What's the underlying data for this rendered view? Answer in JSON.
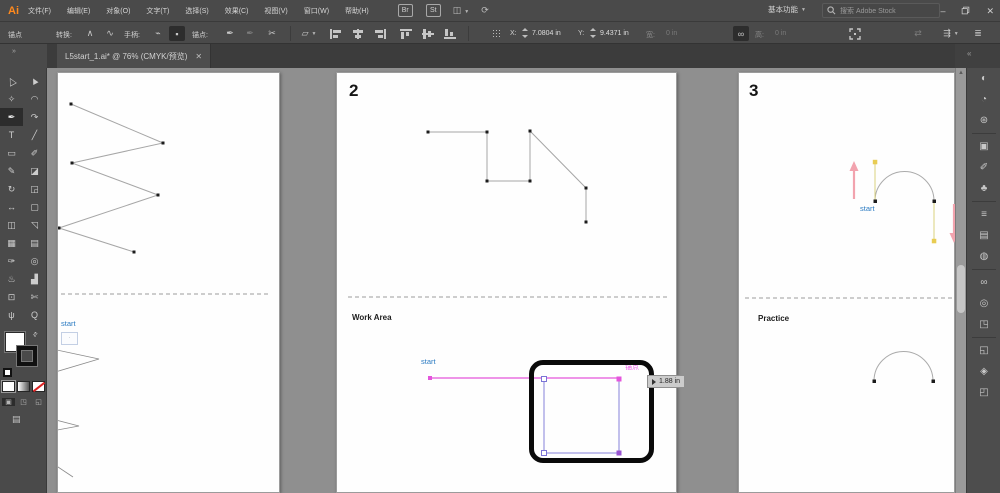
{
  "colors": {
    "chrome_bg": "#4a4a4a",
    "pasteboard": "#8f8f8f",
    "accent_blue": "#2b7bc2",
    "smart_guide_magenta": "#e455dc",
    "path_violet": "#8781d9",
    "handle_yellow": "#e8cc52",
    "arrow_pink": "#f2a3ae"
  },
  "menu_bar": {
    "logo": "Ai",
    "items": [
      {
        "label": "文件(F)"
      },
      {
        "label": "编辑(E)"
      },
      {
        "label": "对象(O)"
      },
      {
        "label": "文字(T)"
      },
      {
        "label": "选择(S)"
      },
      {
        "label": "效果(C)"
      },
      {
        "label": "视图(V)"
      },
      {
        "label": "窗口(W)"
      },
      {
        "label": "帮助(H)"
      }
    ],
    "badges": [
      {
        "label": "Br"
      },
      {
        "label": "St"
      }
    ],
    "workspace": "基本功能",
    "search_placeholder": "搜索 Adobe Stock",
    "window": {
      "minimize": "–",
      "close": "✕"
    }
  },
  "control_bar": {
    "selection_type": "锚点",
    "convert_label": "转换:",
    "handles_label": "手柄:",
    "anchors_label": "锚点:",
    "x_label": "X:",
    "x_value": "7.0804 in",
    "y_label": "Y:",
    "y_value": "9.4371 in",
    "width_label": "宽:",
    "width_value": "0 in",
    "height_label": "高:",
    "height_value": "0 in"
  },
  "tab_bar": {
    "document_title": "L5start_1.ai* @ 76% (CMYK/预览)",
    "close": "✕"
  },
  "tools": [
    {
      "name": "selection-tool",
      "glyph": "△",
      "cls": "arrow-outline"
    },
    {
      "name": "direct-selection-tool",
      "glyph": "▲",
      "cls": "arrow-filled"
    },
    {
      "name": "magic-wand-tool",
      "glyph": "✧"
    },
    {
      "name": "lasso-tool",
      "glyph": "◠"
    },
    {
      "name": "pen-tool",
      "glyph": "✒",
      "selected": true
    },
    {
      "name": "curvature-tool",
      "glyph": "↷"
    },
    {
      "name": "type-tool",
      "glyph": "T"
    },
    {
      "name": "line-segment-tool",
      "glyph": "╱"
    },
    {
      "name": "rectangle-tool",
      "glyph": "▭"
    },
    {
      "name": "paintbrush-tool",
      "glyph": "✐"
    },
    {
      "name": "pencil-tool",
      "glyph": "✎"
    },
    {
      "name": "eraser-tool",
      "glyph": "◪"
    },
    {
      "name": "rotate-tool",
      "glyph": "↻"
    },
    {
      "name": "scale-tool",
      "glyph": "◲"
    },
    {
      "name": "width-tool",
      "glyph": "↔"
    },
    {
      "name": "free-transform-tool",
      "glyph": "▢"
    },
    {
      "name": "shape-builder-tool",
      "glyph": "◫"
    },
    {
      "name": "perspective-grid-tool",
      "glyph": "◹"
    },
    {
      "name": "mesh-tool",
      "glyph": "▦"
    },
    {
      "name": "gradient-tool",
      "glyph": "▤"
    },
    {
      "name": "eyedropper-tool",
      "glyph": "✑"
    },
    {
      "name": "blend-tool",
      "glyph": "◎"
    },
    {
      "name": "symbol-sprayer-tool",
      "glyph": "♨"
    },
    {
      "name": "column-graph-tool",
      "glyph": "▟"
    },
    {
      "name": "artboard-tool",
      "glyph": "⊡"
    },
    {
      "name": "slice-tool",
      "glyph": "✄"
    },
    {
      "name": "hand-tool",
      "glyph": "ψ"
    },
    {
      "name": "zoom-tool",
      "glyph": "Q"
    }
  ],
  "canvas": {
    "artboard_1": {
      "start_label": "start"
    },
    "artboard_2": {
      "number": "2",
      "section_label": "Work Area",
      "start_label": "start",
      "smart_guide_label": "锚点",
      "measure_label": "1.88 in"
    },
    "artboard_3": {
      "number": "3",
      "section_label": "Practice",
      "start_label": "start"
    }
  },
  "panel_dock": [
    {
      "name": "color-panel",
      "glyph": "◐"
    },
    {
      "name": "color-guide-panel",
      "glyph": "◔"
    },
    {
      "name": "pattern-options-panel",
      "glyph": "⊛"
    },
    {
      "name": "info-panel",
      "glyph": "▣"
    },
    {
      "name": "brushes-panel",
      "glyph": "✐"
    },
    {
      "name": "symbols-panel",
      "glyph": "♣"
    },
    {
      "name": "stroke-panel",
      "glyph": "≡"
    },
    {
      "name": "gradient-panel",
      "glyph": "▤"
    },
    {
      "name": "transparency-panel",
      "glyph": "◍"
    },
    {
      "name": "links-panel",
      "glyph": "∞"
    },
    {
      "name": "appearance-panel",
      "glyph": "◎"
    },
    {
      "name": "graphic-styles-panel",
      "glyph": "◳"
    },
    {
      "name": "artboards-panel",
      "glyph": "◱"
    },
    {
      "name": "layers-panel",
      "glyph": "◈"
    },
    {
      "name": "asset-export-panel",
      "glyph": "◰"
    }
  ]
}
